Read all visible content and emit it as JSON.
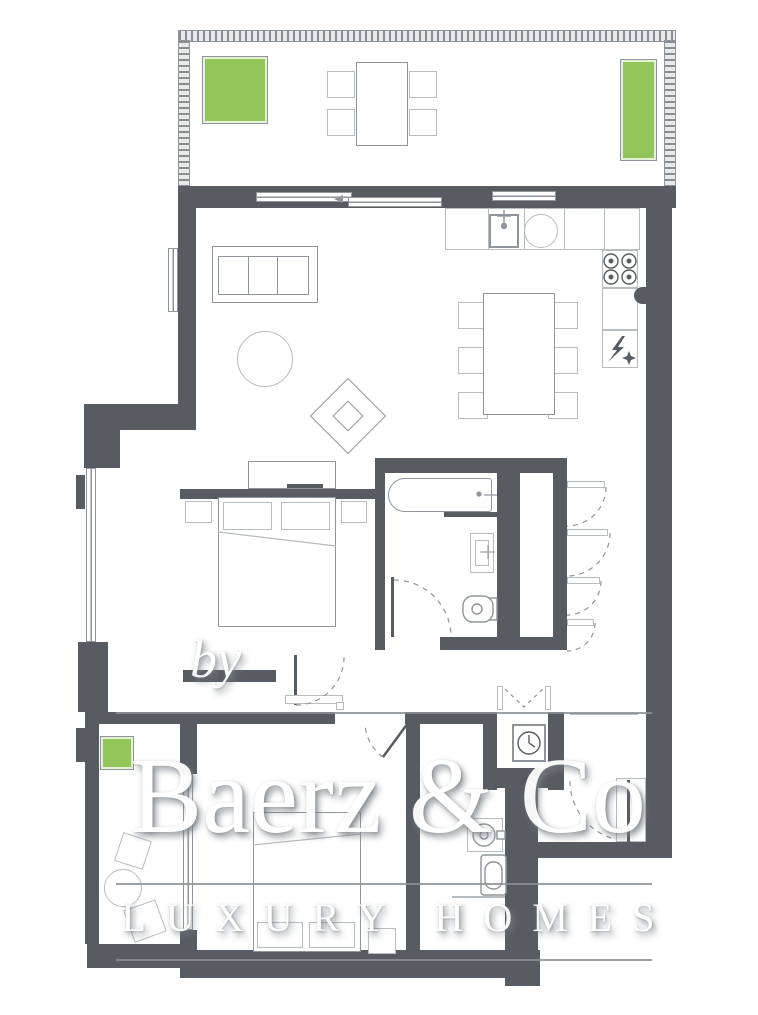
{
  "watermark": {
    "prefix": "by",
    "brand": "Baerz & Co",
    "tagline": "LUXURY HOMES"
  },
  "colors": {
    "wall": "#575c62",
    "line": "#8f959a",
    "line_light": "#b7bcc0",
    "green": "#92c65a",
    "green_dark": "#77b23c",
    "watermark": "#ffffff",
    "background": "#ffffff"
  },
  "icons": {
    "kitchen_faucet_icon": "tap-tee",
    "hob_icon": "four-burner-rings",
    "fridge_icon": "lightning-bolt-and-snowflake",
    "washing_machine_icon": "drum-with-dial",
    "toilet_icon": "bowl-outline",
    "washbasin_icon": "rectangular-basin",
    "bathtub_icon": "rounded-tub-with-tap",
    "wardrobe_doors_icon": "hinged-leaves-with-dashed-arcs",
    "double_door_icon": "two-leaves-dashed-v",
    "sliding_door_arrow_icon": "left-arrow"
  }
}
